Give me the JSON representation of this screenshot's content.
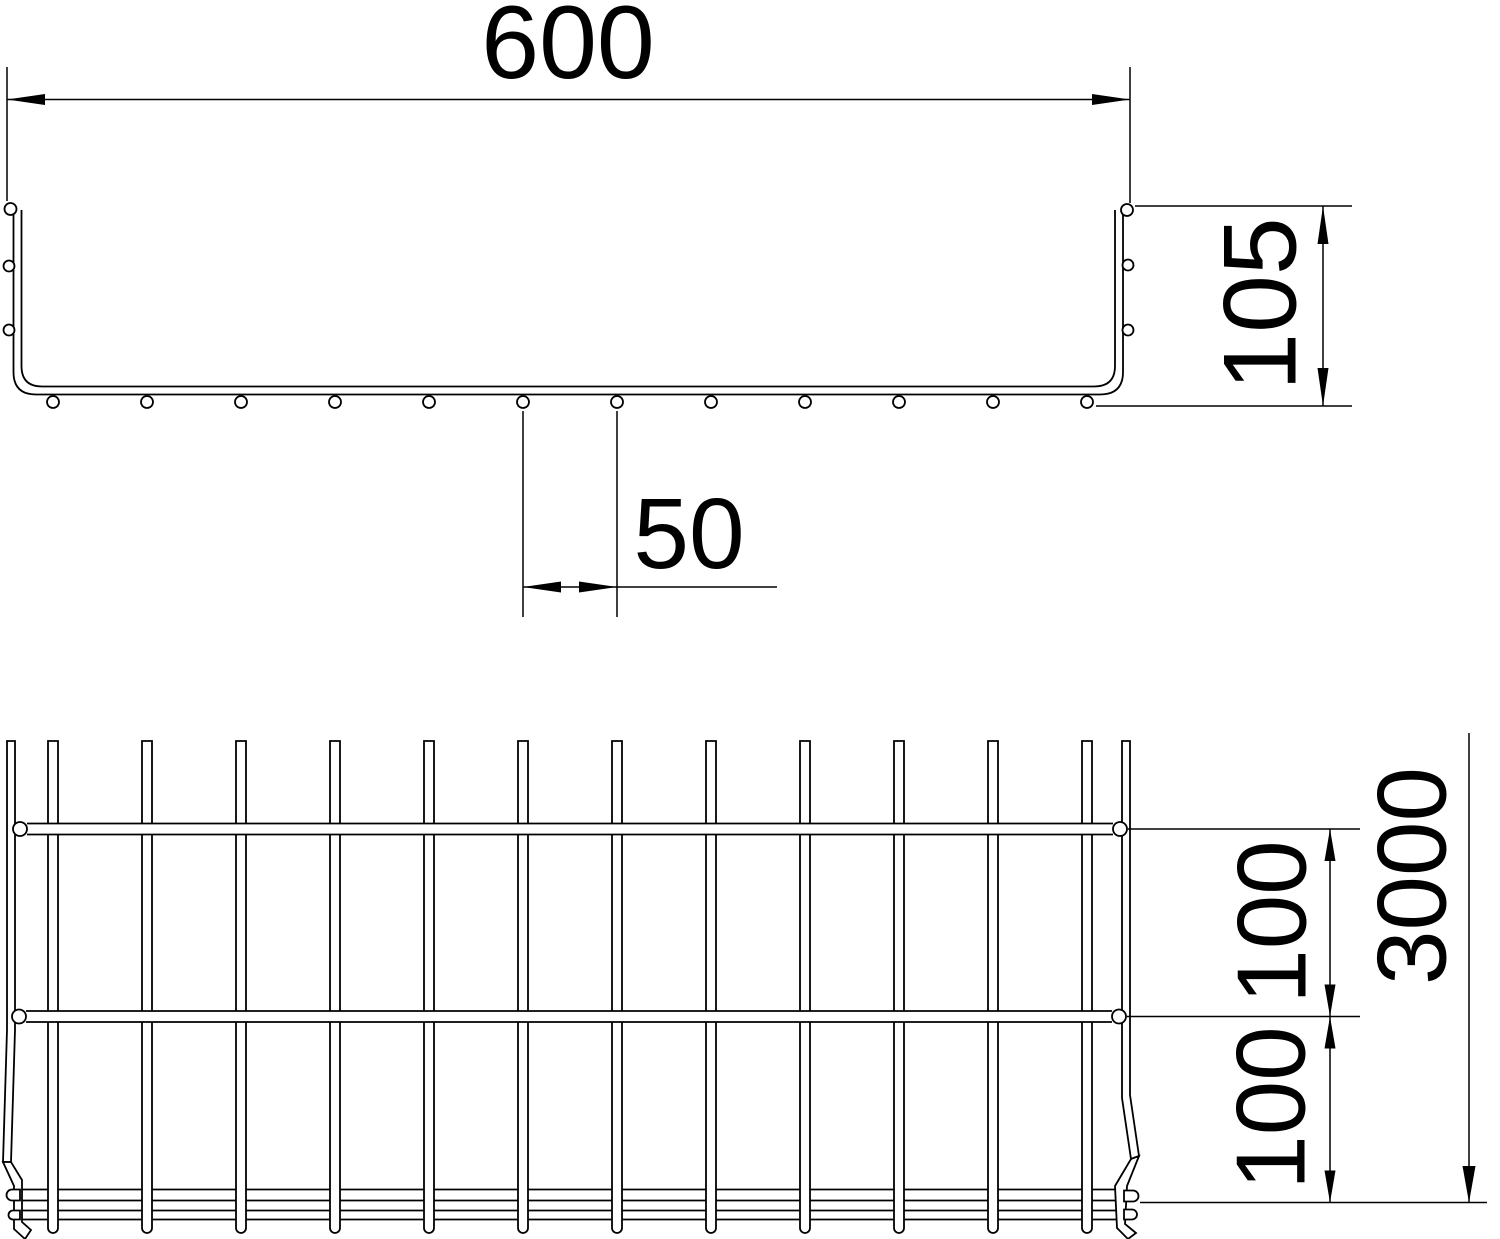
{
  "drawing": {
    "title": "mesh-cable-tray-dimension-drawing",
    "line_color": "#000000",
    "background_color": "#ffffff",
    "views": {
      "cross_section": {
        "dimensions": {
          "width_label": "600",
          "height_label": "105",
          "wire_spacing_label": "50"
        }
      },
      "plan": {
        "dimensions": {
          "mesh_pitch_upper_label": "100",
          "mesh_pitch_lower_label": "100",
          "length_label": "3000"
        }
      }
    }
  }
}
